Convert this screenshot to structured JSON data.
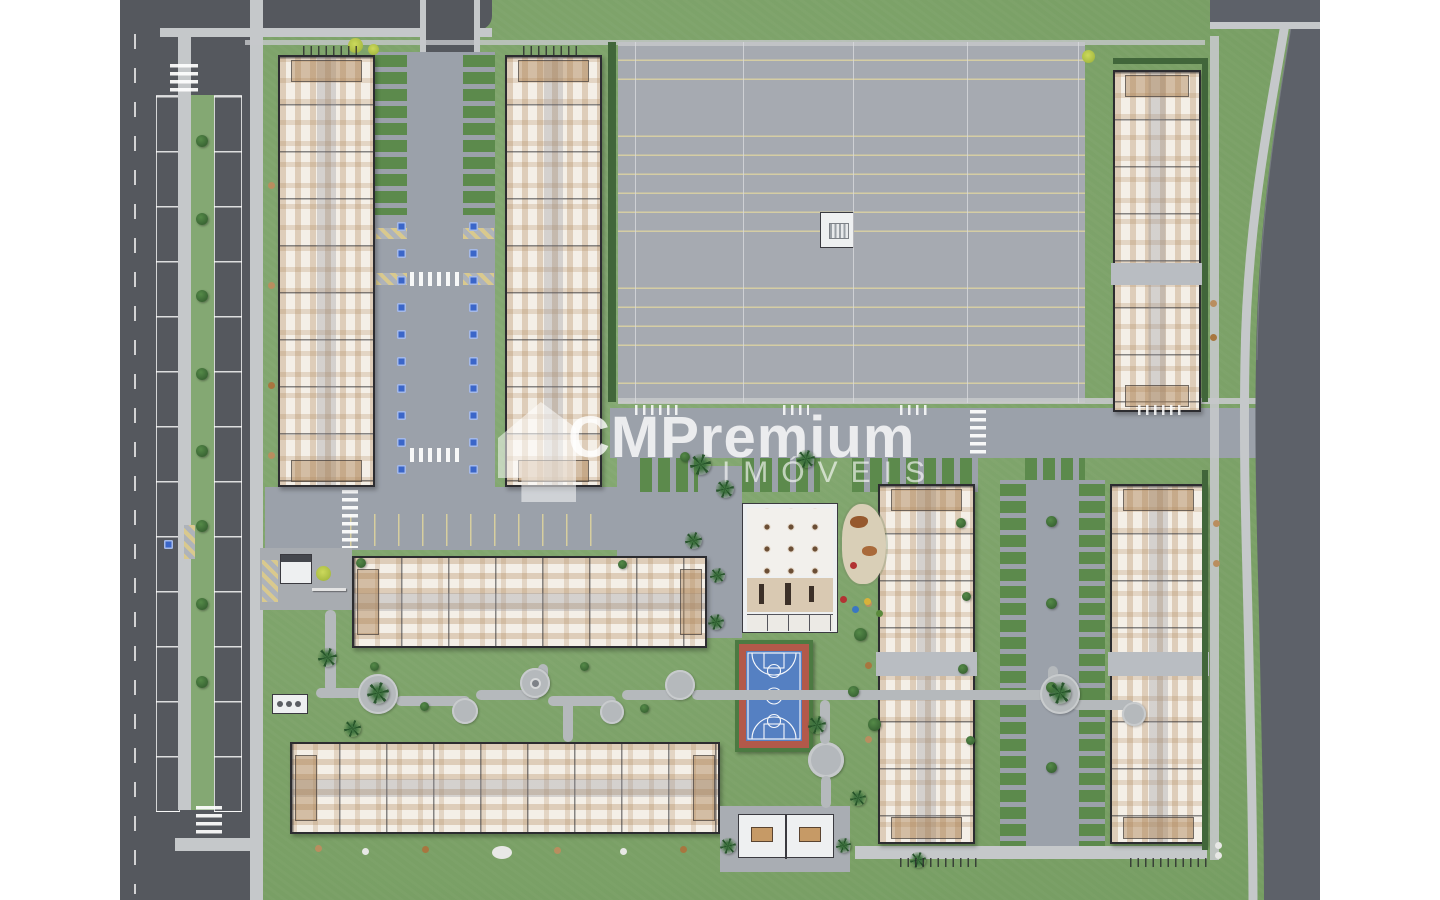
{
  "watermark": {
    "brand": "CMPremium",
    "subtitle": "IMÓVEIS"
  },
  "palette": {
    "page_bg": "#ffffff",
    "grass": "#7da26b",
    "street": "#55585e",
    "road": "#9ba1aa",
    "lot": "#a6aab1",
    "walk": "#c5c8ca",
    "bfill": "#f4efe7",
    "bline": "#2c2c30",
    "paver": "#5c8a4c",
    "ystripe": "#d6cd9b",
    "hatch": "#d9c98e",
    "hblue": "#3b66c9",
    "court_blue": "#5580c2",
    "court_red": "#b2594a",
    "court_green": "#4c7a42",
    "tree_green": "#3f6b38",
    "palm_green": "#2f5c31",
    "sand": "#d9cfb7"
  }
}
